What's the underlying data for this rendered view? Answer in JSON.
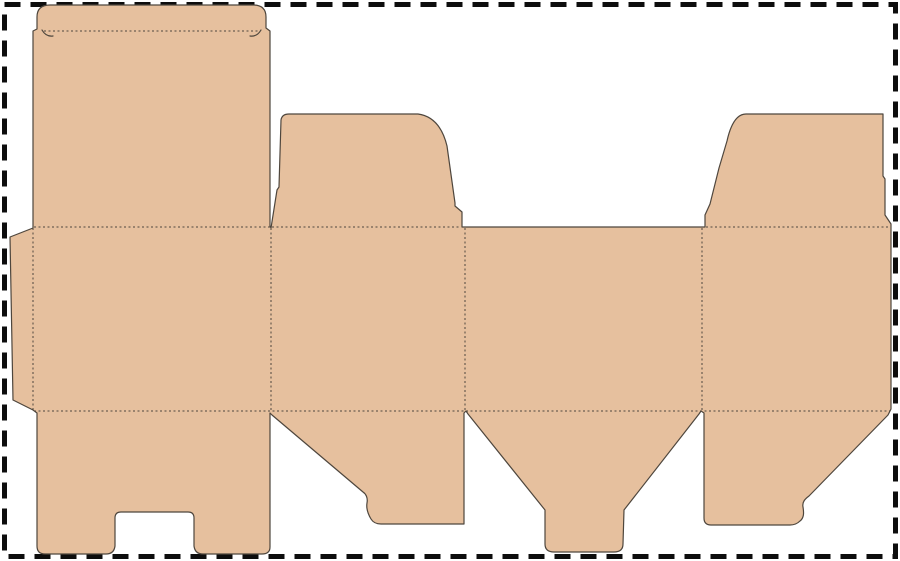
{
  "canvas": {
    "width": 900,
    "height": 561,
    "background_color": "#ffffff"
  },
  "colors": {
    "board_fill": "#e6c09e",
    "cut_line": "#4e463d",
    "fold_line": "#4e463d",
    "page_border": "#0d0d0d"
  },
  "page_border": {
    "style": "dashed",
    "thickness": 5,
    "dash_pattern": "16 10"
  },
  "dieline": {
    "description": "Flat die-cut template (dieline) of a folding carton, unfolded on white background",
    "parts": [
      {
        "name": "glue-flap",
        "location": "far left edge of middle row"
      },
      {
        "name": "back-panel",
        "location": "first (left) panel of middle row"
      },
      {
        "name": "tuck-lid-flap",
        "location": "tall top-left panel with rounded tuck flap"
      },
      {
        "name": "dust-flap-left",
        "location": "curved flap above second panel"
      },
      {
        "name": "front-panel",
        "location": "third panel of middle row, no top flap"
      },
      {
        "name": "dust-flap-right",
        "location": "curved flap above fourth panel"
      },
      {
        "name": "bottom-flap-notched",
        "location": "below first panel, rectangular notch cut from bottom edge"
      },
      {
        "name": "bottom-flap-angled-left",
        "location": "below second panel, diagonal cut with hook"
      },
      {
        "name": "bottom-flap-tongue",
        "location": "below third panel, funnel shape with narrow tongue"
      },
      {
        "name": "bottom-flap-angled-right",
        "location": "below fourth panel, mirrored diagonal cut with hook"
      }
    ],
    "fold_line_style": {
      "dash_pattern": "2 2.5",
      "thickness": 1
    },
    "cut_line_thickness": 1.2,
    "geometry": {
      "outline": "M 50 5 H 253 Q 266 5 266 17 V 28 L 270 31 V 226 L 271 228 L 277 190 L 279 187 L 281 120 Q 282 114 289 114 H 418 Q 440 117 447 146 L 455 203 L 455 206 L 462 212 L 462 227 L 467 227 H 699 L 705 227 L 705 215 L 710 204 L 719 168 L 727 141 Q 733 114 746 114 H 883 V 176 L 885 179 V 215 L 891 224 V 409 L 888 415 L 809 496 C 805 499 802 502 803 507 C 804 513 804 518 800 521 Q 796 525 790 525 H 711 Q 704 525 704 518 V 413 L 701 411 L 699 414 L 624 510 L 623 544 Q 623 552 614 552 H 554 Q 545 552 545 544 L 545 510 L 468 414 L 466 411 L 464 413 V 524 H 381 Q 374 524 371 519 C 368 514 366 509 367 503 C 368 498 366 494 363 492 L 272 415 L 270 413 V 547 Q 270 554 262 554 H 203 Q 195 554 194 546 V 518 Q 194 512 188 512 H 121 Q 115 512 115 518 V 546 Q 114 554 106 554 H 45 Q 37 554 37 546 V 413 L 33 410 L 13 400 L 10 237 L 33 228 V 31 L 37 29 V 17 Q 37 5 50 5 Z",
      "fold_lines": "M 44 31 H 258 M 33 228 V 410 M 271 228 V 410 M 465 228 V 410 M 702 228 V 410 M 34 227 H 270 M 272 227 H 461 M 706 227 H 890 M 34 411 H 890",
      "notch_marks": "M 42 30 Q 46 37 53 36 M 261 30 Q 257 37 250 36"
    }
  }
}
